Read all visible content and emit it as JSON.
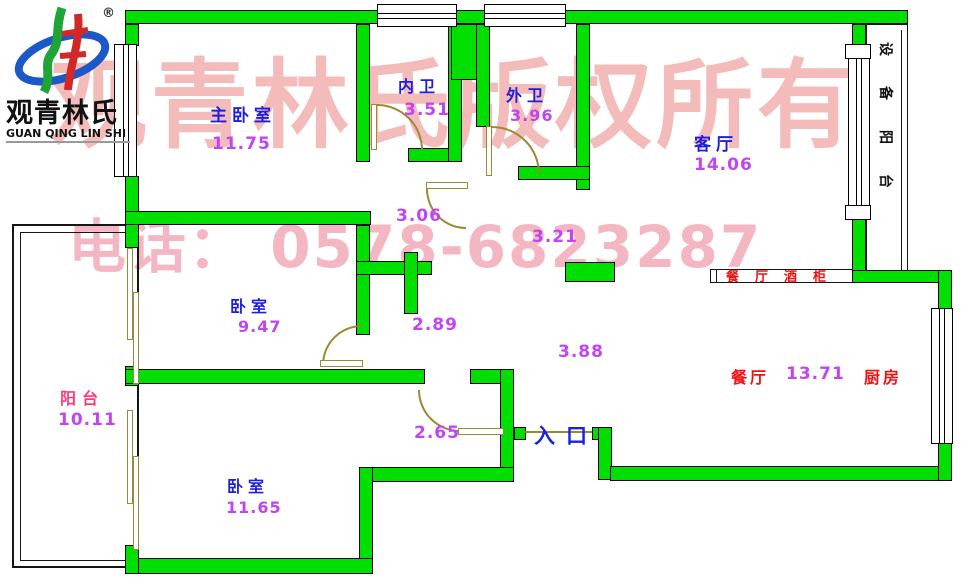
{
  "logo": {
    "brand_cn": "观青林氏",
    "brand_en": "GUAN QING LIN SHI",
    "registered": "®"
  },
  "watermark": {
    "line1": "观青林氏版权所有",
    "line2": "电话：  0578-6823287"
  },
  "rooms": {
    "master": {
      "name": "主卧室",
      "area": "11.75"
    },
    "inner_bath": {
      "name": "内卫",
      "area": "3.51"
    },
    "outer_bath": {
      "name": "外卫",
      "area": "3.96"
    },
    "living": {
      "name": "客厅",
      "area": "14.06"
    },
    "bedroom_mid": {
      "name": "卧室",
      "area": "9.47"
    },
    "balcony": {
      "name": "阳台",
      "area": "10.11"
    },
    "bedroom_low": {
      "name": "卧室",
      "area": "11.65"
    },
    "dining": {
      "name": "餐厅",
      "area": "13.71"
    },
    "kitchen": {
      "name": "厨房"
    },
    "equipment_balcony": {
      "name": "设备阳台"
    }
  },
  "passage_dims": {
    "hall_top": "3.06",
    "hall_right": "3.21",
    "hall_mid": "2.89",
    "hall_center": "3.88",
    "hall_low": "2.65"
  },
  "labels": {
    "entrance": "入口",
    "wine_cabinet": "餐厅酒柜"
  },
  "colors": {
    "wall": "#00df00",
    "room_label": "#1e1edc",
    "area_value": "#c244f2",
    "red_label": "#ee1212",
    "balcony_label": "#ff3a7a",
    "entrance_label": "#1522e6",
    "door_window": "#9a8a35",
    "watermark": "#f4bbbb"
  }
}
